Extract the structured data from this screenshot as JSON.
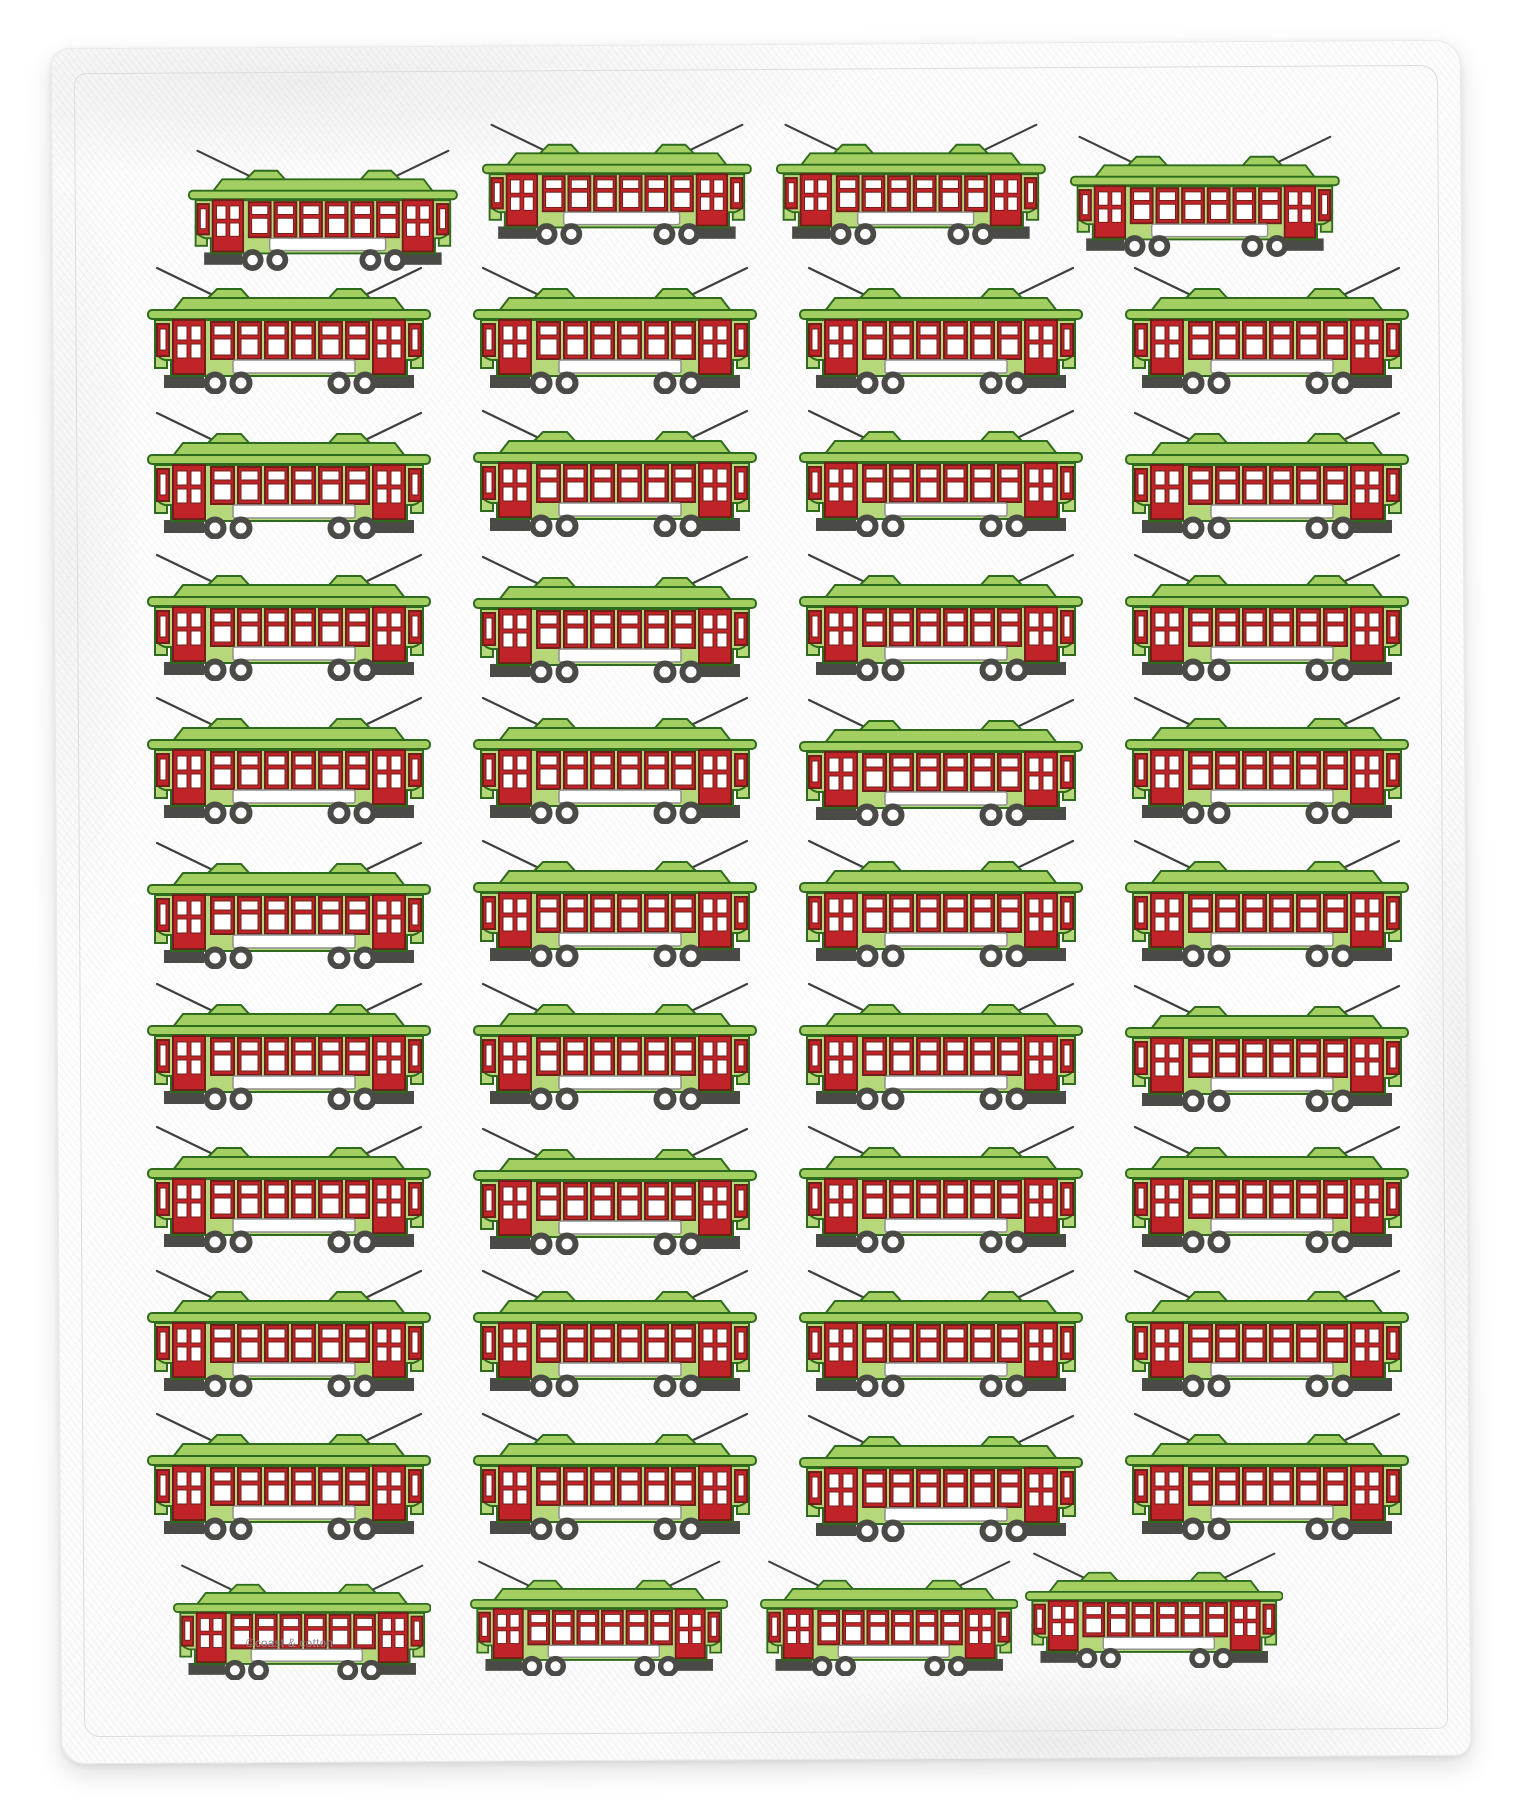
{
  "product": {
    "type": "flour-sack kitchen towel product photo",
    "brand_mark": "©coast & cotton",
    "motif": "new-orleans-streetcar",
    "motif_count": 44
  },
  "colors": {
    "bodyGreen": "#b6d77a",
    "roofGreen": "#a3ce62",
    "outlineGreen": "#2e6b1d",
    "frameRed": "#c02428",
    "frameDarkRed": "#70201a",
    "paneWhite": "#ffffff",
    "signboardEdge": "#8f8f8f",
    "wheelGray": "#4a4a47",
    "antennaGray": "#3e3e3c",
    "hemLine": "#dcdcdf",
    "brandText": "#8a8a8a"
  },
  "motif_details": {
    "windows_per_car": 6,
    "doors_per_car": 2,
    "wheels_per_car": 4,
    "roof_vents": 2,
    "trolley_poles": 2,
    "signboard": "blank white strip"
  },
  "pattern": {
    "rows": [
      {
        "y": 121,
        "scale": 0.95,
        "cars": [
          {
            "x": 188,
            "dy": 26
          },
          {
            "x": 482,
            "dy": 0
          },
          {
            "x": 776,
            "dy": 0
          },
          {
            "x": 1070,
            "dy": 12
          }
        ]
      },
      {
        "y": 264,
        "scale": 1,
        "cars": [
          {
            "x": 147,
            "dy": 0
          },
          {
            "x": 473,
            "dy": 0
          },
          {
            "x": 799,
            "dy": 0
          },
          {
            "x": 1125,
            "dy": 0
          }
        ]
      },
      {
        "y": 407,
        "scale": 1,
        "cars": [
          {
            "x": 147,
            "dy": 2
          },
          {
            "x": 473,
            "dy": 0
          },
          {
            "x": 799,
            "dy": 0
          },
          {
            "x": 1125,
            "dy": 2
          }
        ]
      },
      {
        "y": 551,
        "scale": 1,
        "cars": [
          {
            "x": 147,
            "dy": 0
          },
          {
            "x": 473,
            "dy": 2
          },
          {
            "x": 799,
            "dy": 0
          },
          {
            "x": 1125,
            "dy": 0
          }
        ]
      },
      {
        "y": 694,
        "scale": 1,
        "cars": [
          {
            "x": 147,
            "dy": 0
          },
          {
            "x": 473,
            "dy": 0
          },
          {
            "x": 799,
            "dy": 2
          },
          {
            "x": 1125,
            "dy": 0
          }
        ]
      },
      {
        "y": 837,
        "scale": 1,
        "cars": [
          {
            "x": 147,
            "dy": 2
          },
          {
            "x": 473,
            "dy": 0
          },
          {
            "x": 799,
            "dy": 0
          },
          {
            "x": 1125,
            "dy": 0
          }
        ]
      },
      {
        "y": 980,
        "scale": 1,
        "cars": [
          {
            "x": 147,
            "dy": 0
          },
          {
            "x": 473,
            "dy": 0
          },
          {
            "x": 799,
            "dy": 0
          },
          {
            "x": 1125,
            "dy": 2
          }
        ]
      },
      {
        "y": 1123,
        "scale": 1,
        "cars": [
          {
            "x": 147,
            "dy": 0
          },
          {
            "x": 473,
            "dy": 2
          },
          {
            "x": 799,
            "dy": 0
          },
          {
            "x": 1125,
            "dy": 0
          }
        ]
      },
      {
        "y": 1267,
        "scale": 1,
        "cars": [
          {
            "x": 147,
            "dy": 0
          },
          {
            "x": 473,
            "dy": 0
          },
          {
            "x": 799,
            "dy": 0
          },
          {
            "x": 1125,
            "dy": 0
          }
        ]
      },
      {
        "y": 1410,
        "scale": 1,
        "cars": [
          {
            "x": 147,
            "dy": 0
          },
          {
            "x": 473,
            "dy": 0
          },
          {
            "x": 799,
            "dy": 2
          },
          {
            "x": 1125,
            "dy": 0
          }
        ]
      },
      {
        "y": 1556,
        "scale": 0.91,
        "cars": [
          {
            "x": 173,
            "dy": 6
          },
          {
            "x": 470,
            "dy": 2
          },
          {
            "x": 760,
            "dy": 2
          },
          {
            "x": 1025,
            "dy": -6
          }
        ]
      }
    ]
  }
}
